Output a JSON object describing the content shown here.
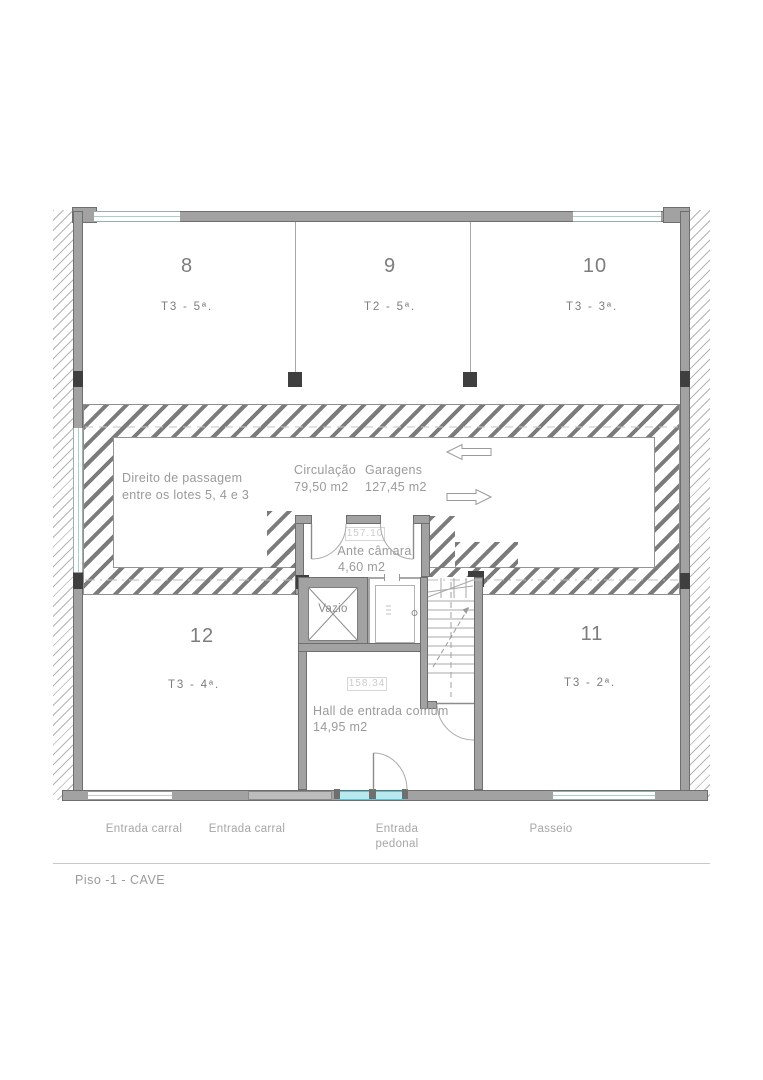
{
  "drawing": {
    "caption": "Piso -1 - CAVE",
    "rooms": [
      {
        "number": "8",
        "type": "T3 - 5ª."
      },
      {
        "number": "9",
        "type": "T2 - 5ª."
      },
      {
        "number": "10",
        "type": "T3 - 3ª."
      },
      {
        "number": "12",
        "type": "T3 - 4ª."
      },
      {
        "number": "11",
        "type": "T3 - 2ª."
      }
    ],
    "easement": {
      "line1": "Direito de passagem",
      "line2": "entre os lotes 5, 4 e 3"
    },
    "circulation": {
      "label": "Circulação",
      "area": "79,50 m2"
    },
    "garages": {
      "label": "Garagens",
      "area": "127,45 m2"
    },
    "antechamber": {
      "label": "Ante câmara",
      "area": "4,60 m2",
      "level": "157.10"
    },
    "hall": {
      "label": "Hall de entrada comum",
      "area": "14,95 m2",
      "level": "158.34"
    },
    "void_shaft": {
      "label": "Vazio"
    },
    "street_labels": [
      "Entrada carral",
      "Entrada carral",
      "Entrada pedonal",
      "Passeio"
    ],
    "colors": {
      "wall_gray": "#a2a2a2",
      "pillar_dark": "#3f3f3f",
      "hatch_gray": "#7b7b7b",
      "entrance_cyan": "#b9e9ef",
      "window_teal": "#a9cfc9",
      "text_gray": "#9a9a9a"
    }
  }
}
